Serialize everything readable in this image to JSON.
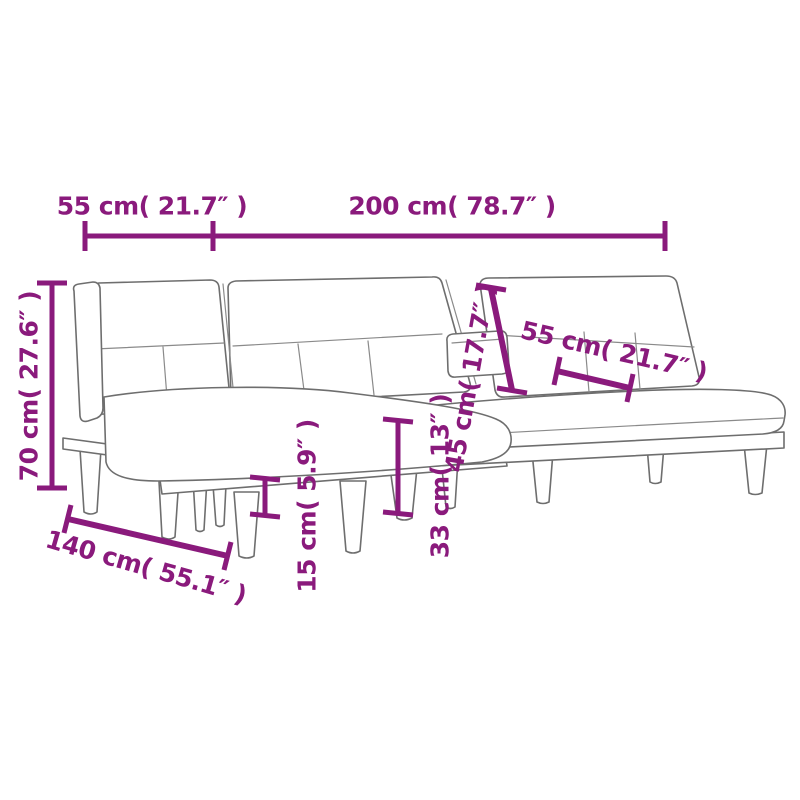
{
  "image": {
    "type": "furniture-dimension-diagram",
    "subject": "L-shaped sofa bed line drawing with measurements",
    "background_color": "#ffffff",
    "accent_color": "#8a1a7c",
    "outline_color": "#6e6e6e"
  },
  "labels": {
    "chaise_width_top": "55 cm( 21.7″ )",
    "sofa_length_top": "200 cm( 78.7″ )",
    "overall_height": "70 cm( 27.6″ )",
    "backrest_height": "45 cm( 17.7″ )",
    "seat_depth": "55 cm( 21.7″ )",
    "chaise_length": "140 cm( 55.1″ )",
    "seat_height": "33 cm( 13″ )",
    "leg_height": "15 cm( 5.9″ )"
  }
}
